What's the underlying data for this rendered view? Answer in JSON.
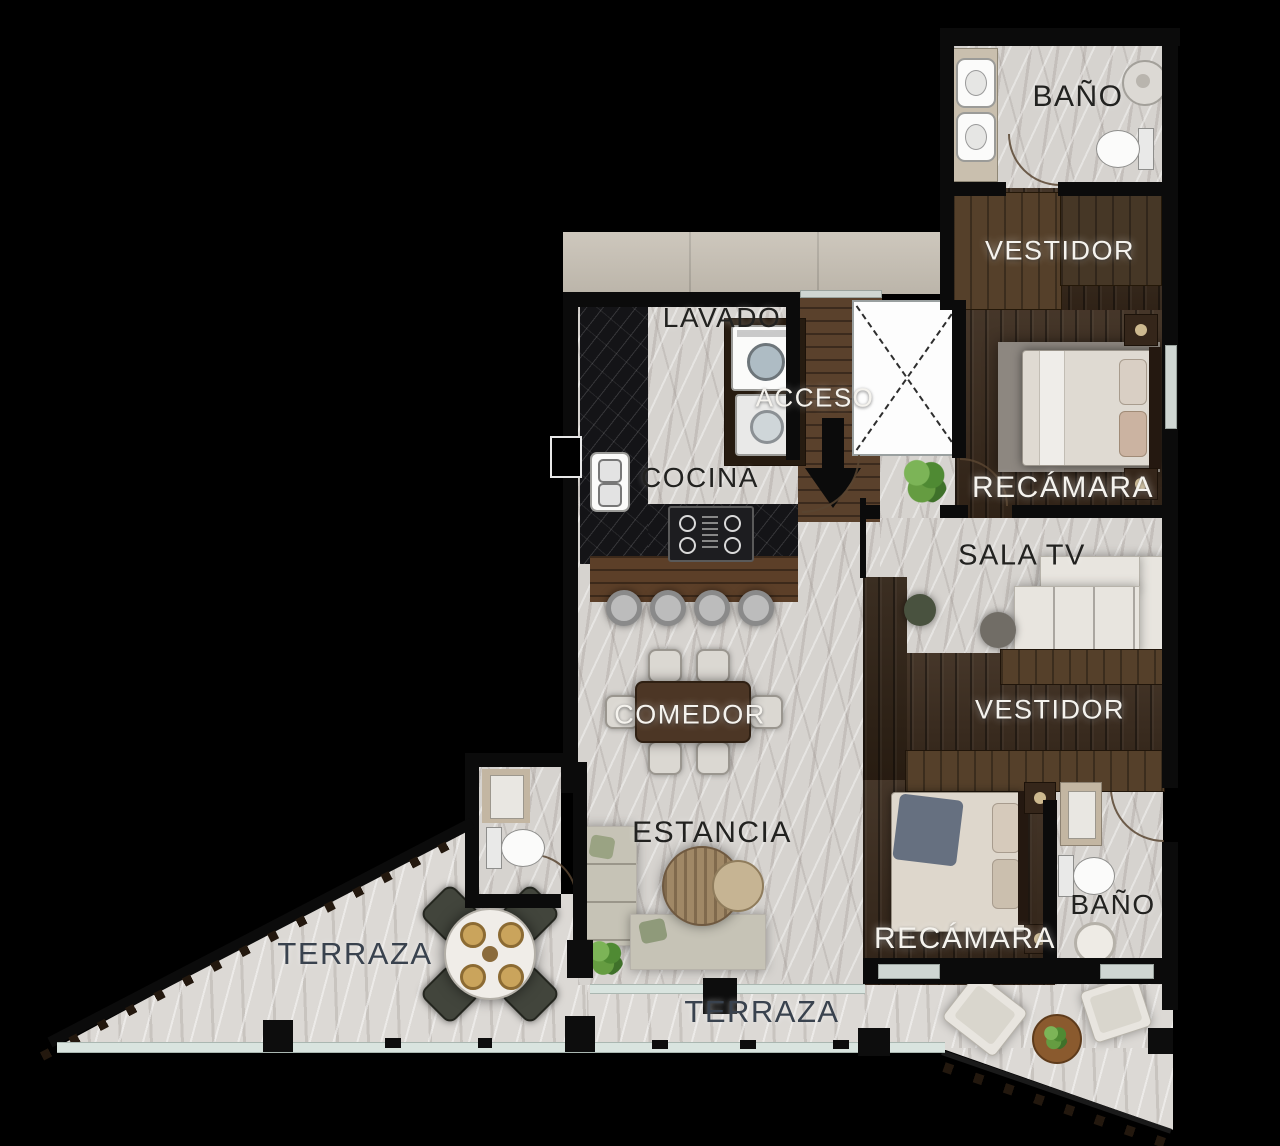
{
  "title": "Planta arquitectónica - departamento",
  "rooms": [
    {
      "id": "bano_top",
      "label": "BAÑO"
    },
    {
      "id": "vestidor_top",
      "label": "VESTIDOR"
    },
    {
      "id": "lavado",
      "label": "LAVADO"
    },
    {
      "id": "acceso",
      "label": "ACCESO"
    },
    {
      "id": "cocina",
      "label": "COCINA"
    },
    {
      "id": "recamara_top",
      "label": "RECÁMARA"
    },
    {
      "id": "sala_tv",
      "label": "SALA TV"
    },
    {
      "id": "comedor",
      "label": "COMEDOR"
    },
    {
      "id": "vestidor_mid",
      "label": "VESTIDOR"
    },
    {
      "id": "estancia",
      "label": "ESTANCIA"
    },
    {
      "id": "recamara_bottom",
      "label": "RECÁMARA"
    },
    {
      "id": "bano_bottom",
      "label": "BAÑO"
    },
    {
      "id": "terraza_left",
      "label": "TERRAZA"
    },
    {
      "id": "terraza_bottom",
      "label": "TERRAZA"
    }
  ],
  "colors": {
    "background": "#000000",
    "wall": "#0b0b0b",
    "marble_floor": "#d6d3cf",
    "dark_wood_floor": "#3a2a1c",
    "light_wood": "#5a412c",
    "black_counter": "#141417",
    "corridor_band": "#c7c0b4",
    "glass_rail": "#d9e4df",
    "label_dark": "#222220",
    "label_light": "#f5f3ee",
    "label_terrace": "#39424e",
    "plant_green": "#5c9340"
  },
  "fixtures": [
    "double-sink",
    "shower",
    "toilet",
    "closet",
    "double-bed",
    "nightstand",
    "washer",
    "dryer",
    "kitchen-sink",
    "stove",
    "bar-island",
    "bar-stool",
    "dining-table",
    "dining-chair",
    "tv-sofa",
    "pouf",
    "l-sofa",
    "coffee-table",
    "round-table",
    "lounge-chair",
    "planter",
    "elevator-shaft",
    "entry-arrow",
    "door-swing",
    "glass-railing"
  ]
}
